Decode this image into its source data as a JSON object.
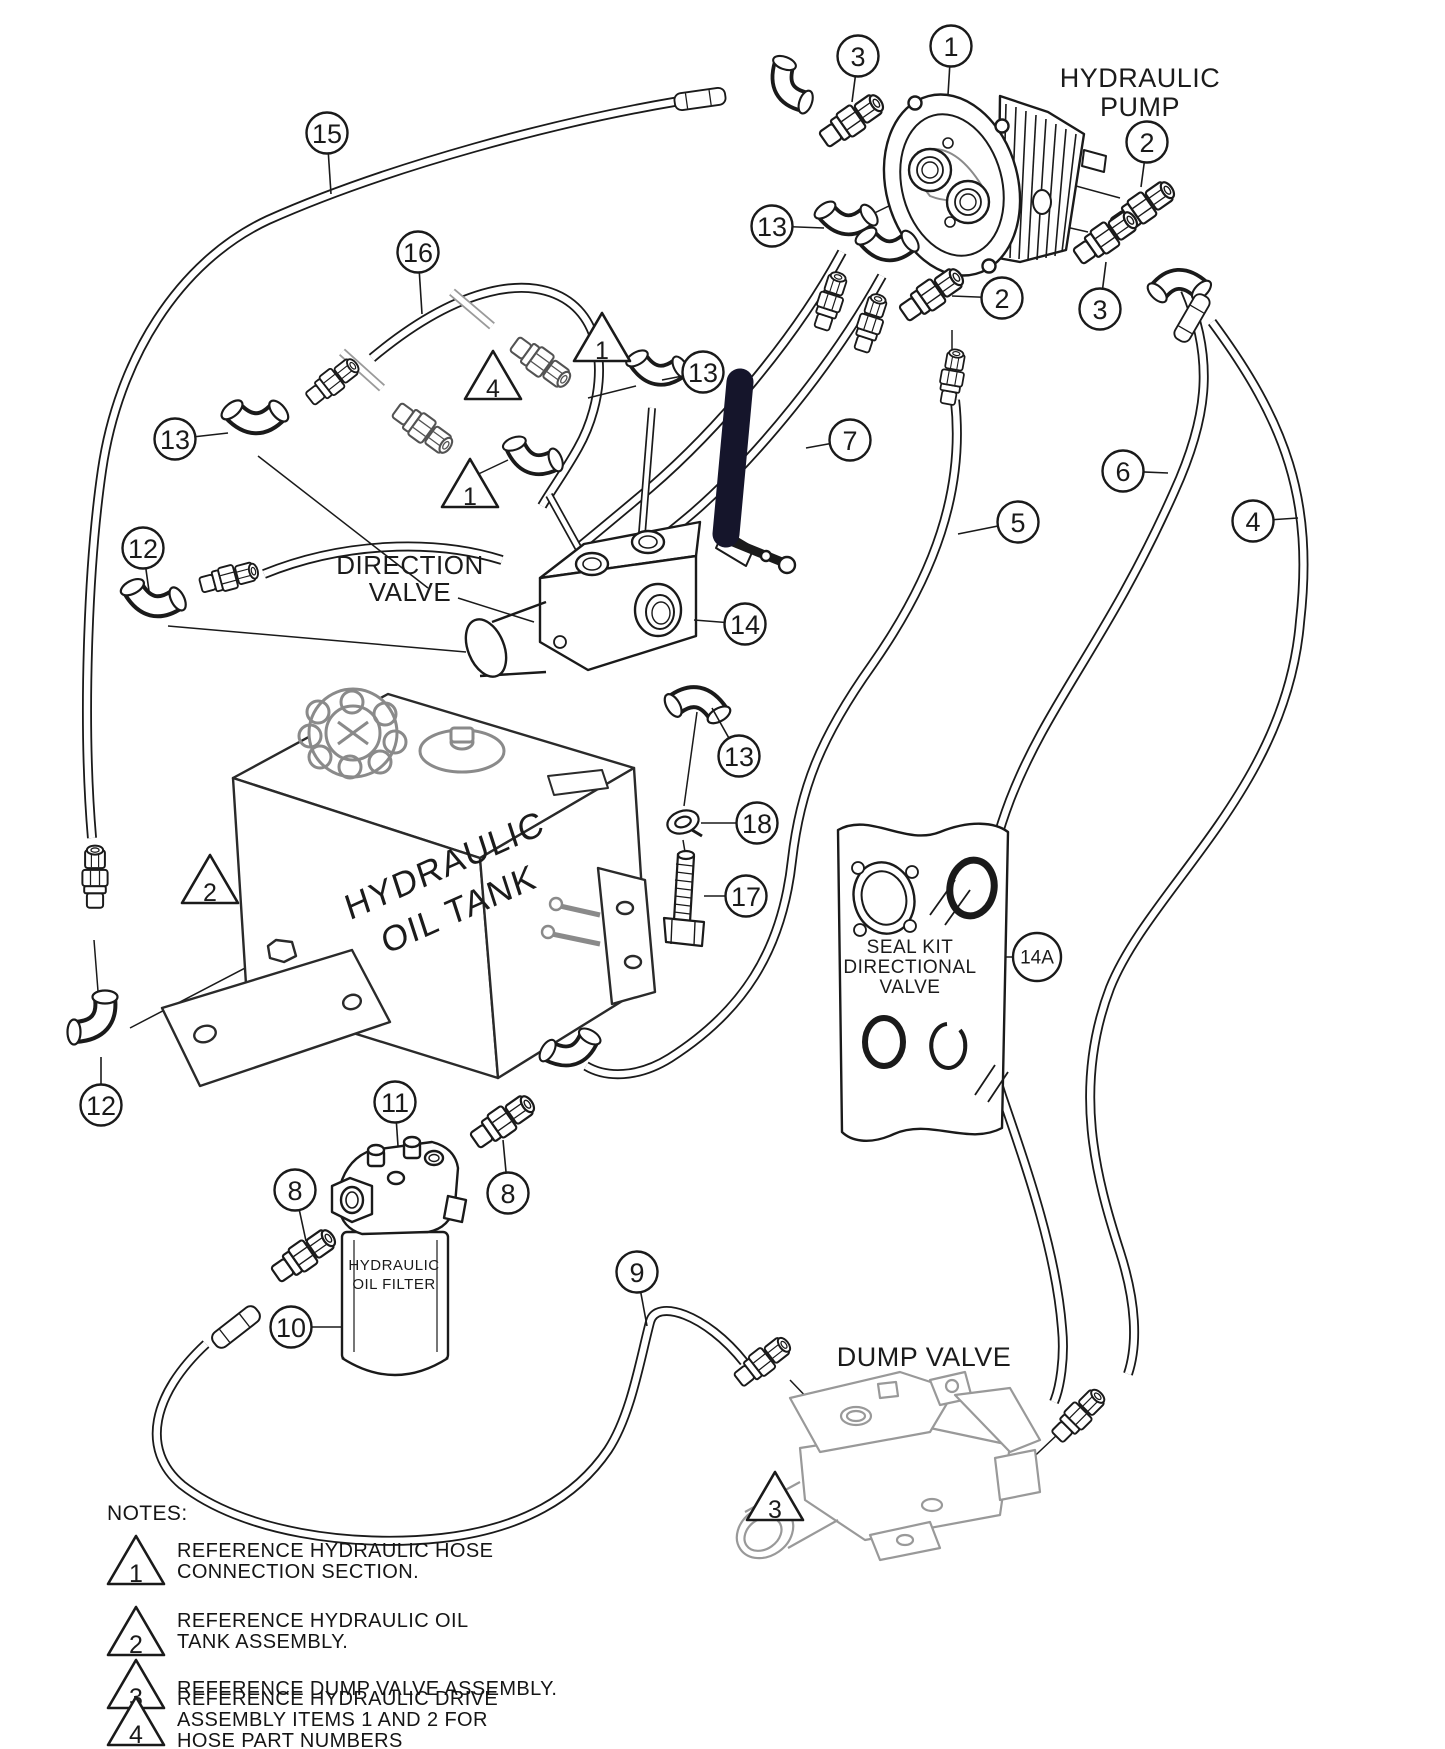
{
  "diagram_title": "hydraulic system exploded parts diagram",
  "colors": {
    "line": "#1a1a1a",
    "ghost": "#9a9a9a",
    "handle": "#15152b",
    "background": "#ffffff"
  },
  "component_labels": [
    {
      "id": "pump",
      "lines": [
        "HYDRAULIC",
        "PUMP"
      ],
      "x": 1140,
      "y": 64,
      "size": 27,
      "lh": 29
    },
    {
      "id": "direction-valve",
      "lines": [
        "DIRECTION",
        "VALVE"
      ],
      "x": 410,
      "y": 552,
      "size": 26,
      "lh": 27
    },
    {
      "id": "seal-kit",
      "lines": [
        "SEAL KIT",
        "DIRECTIONAL",
        "VALVE"
      ],
      "x": 910,
      "y": 938,
      "size": 19,
      "lh": 20
    },
    {
      "id": "dump-valve",
      "lines": [
        "DUMP VALVE"
      ],
      "x": 924,
      "y": 1343,
      "size": 27,
      "lh": 28
    },
    {
      "id": "oil-filter",
      "lines": [
        "HYDRAULIC",
        "OIL FILTER"
      ],
      "x": 394,
      "y": 1256,
      "size": 15,
      "lh": 19
    },
    {
      "id": "oil-tank",
      "lines": [
        "HYDRAULIC",
        "OIL TANK"
      ],
      "x": 452,
      "y": 888,
      "size": 35,
      "lh": 46,
      "rotate": -24
    }
  ],
  "callouts": [
    {
      "label": "3",
      "x": 858,
      "y": 56,
      "leader": [
        852,
        102
      ]
    },
    {
      "label": "1",
      "x": 951,
      "y": 46,
      "leader": [
        948,
        95
      ]
    },
    {
      "label": "2",
      "x": 1147,
      "y": 142,
      "leader": [
        1141,
        187
      ]
    },
    {
      "label": "3",
      "x": 1100,
      "y": 309,
      "leader": [
        1106,
        262
      ]
    },
    {
      "label": "13",
      "x": 772,
      "y": 226,
      "leader": [
        824,
        228
      ]
    },
    {
      "label": "2",
      "x": 1002,
      "y": 298,
      "leader": [
        952,
        296
      ]
    },
    {
      "label": "13",
      "x": 703,
      "y": 372,
      "leader": [
        662,
        380
      ]
    },
    {
      "label": "15",
      "x": 327,
      "y": 133,
      "leader": [
        331,
        194
      ]
    },
    {
      "label": "16",
      "x": 418,
      "y": 252,
      "leader": [
        422,
        314
      ]
    },
    {
      "label": "13",
      "x": 175,
      "y": 439,
      "leader": [
        228,
        433
      ]
    },
    {
      "label": "12",
      "x": 143,
      "y": 548,
      "leader": [
        149,
        591
      ]
    },
    {
      "label": "14",
      "x": 745,
      "y": 624,
      "leader": [
        694,
        620
      ]
    },
    {
      "label": "7",
      "x": 850,
      "y": 440,
      "leader": [
        806,
        448
      ]
    },
    {
      "label": "5",
      "x": 1018,
      "y": 522,
      "leader": [
        958,
        534
      ]
    },
    {
      "label": "6",
      "x": 1123,
      "y": 471,
      "leader": [
        1168,
        473
      ]
    },
    {
      "label": "4",
      "x": 1253,
      "y": 521,
      "leader": [
        1298,
        518
      ]
    },
    {
      "label": "13",
      "x": 739,
      "y": 756,
      "leader": [
        712,
        708
      ]
    },
    {
      "label": "18",
      "x": 757,
      "y": 823,
      "leader": [
        701,
        823
      ]
    },
    {
      "label": "17",
      "x": 746,
      "y": 896,
      "leader": [
        704,
        896
      ]
    },
    {
      "label": "14A",
      "x": 1037,
      "y": 957,
      "leader": [
        1006,
        957
      ]
    },
    {
      "label": "12",
      "x": 101,
      "y": 1105,
      "leader": [
        101,
        1057
      ]
    },
    {
      "label": "11",
      "x": 395,
      "y": 1102,
      "leader": [
        398,
        1146
      ]
    },
    {
      "label": "8",
      "x": 295,
      "y": 1190,
      "leader": [
        306,
        1241
      ]
    },
    {
      "label": "8",
      "x": 508,
      "y": 1193,
      "leader": [
        503,
        1140
      ]
    },
    {
      "label": "10",
      "x": 291,
      "y": 1327,
      "leader": [
        342,
        1327
      ]
    },
    {
      "label": "9",
      "x": 637,
      "y": 1272,
      "leader": [
        647,
        1326
      ]
    }
  ],
  "warning_triangles": [
    {
      "label": "1",
      "x": 602,
      "y": 343
    },
    {
      "label": "4",
      "x": 493,
      "y": 381
    },
    {
      "label": "1",
      "x": 470,
      "y": 489
    },
    {
      "label": "2",
      "x": 210,
      "y": 885
    },
    {
      "label": "3",
      "x": 775,
      "y": 1502
    }
  ],
  "notes": {
    "heading": "NOTES:",
    "items": [
      {
        "label": "1",
        "lines": [
          "REFERENCE HYDRAULIC HOSE",
          "CONNECTION SECTION."
        ]
      },
      {
        "label": "2",
        "lines": [
          "REFERENCE HYDRAULIC OIL",
          "TANK ASSEMBLY."
        ]
      },
      {
        "label": "3",
        "lines": [
          "REFERENCE DUMP VALVE ASSEMBLY."
        ]
      },
      {
        "label": "4",
        "lines": [
          "REFERENCE HYDRAULIC DRIVE",
          "ASSEMBLY ITEMS 1 AND 2 FOR",
          "HOSE PART NUMBERS"
        ]
      }
    ]
  }
}
